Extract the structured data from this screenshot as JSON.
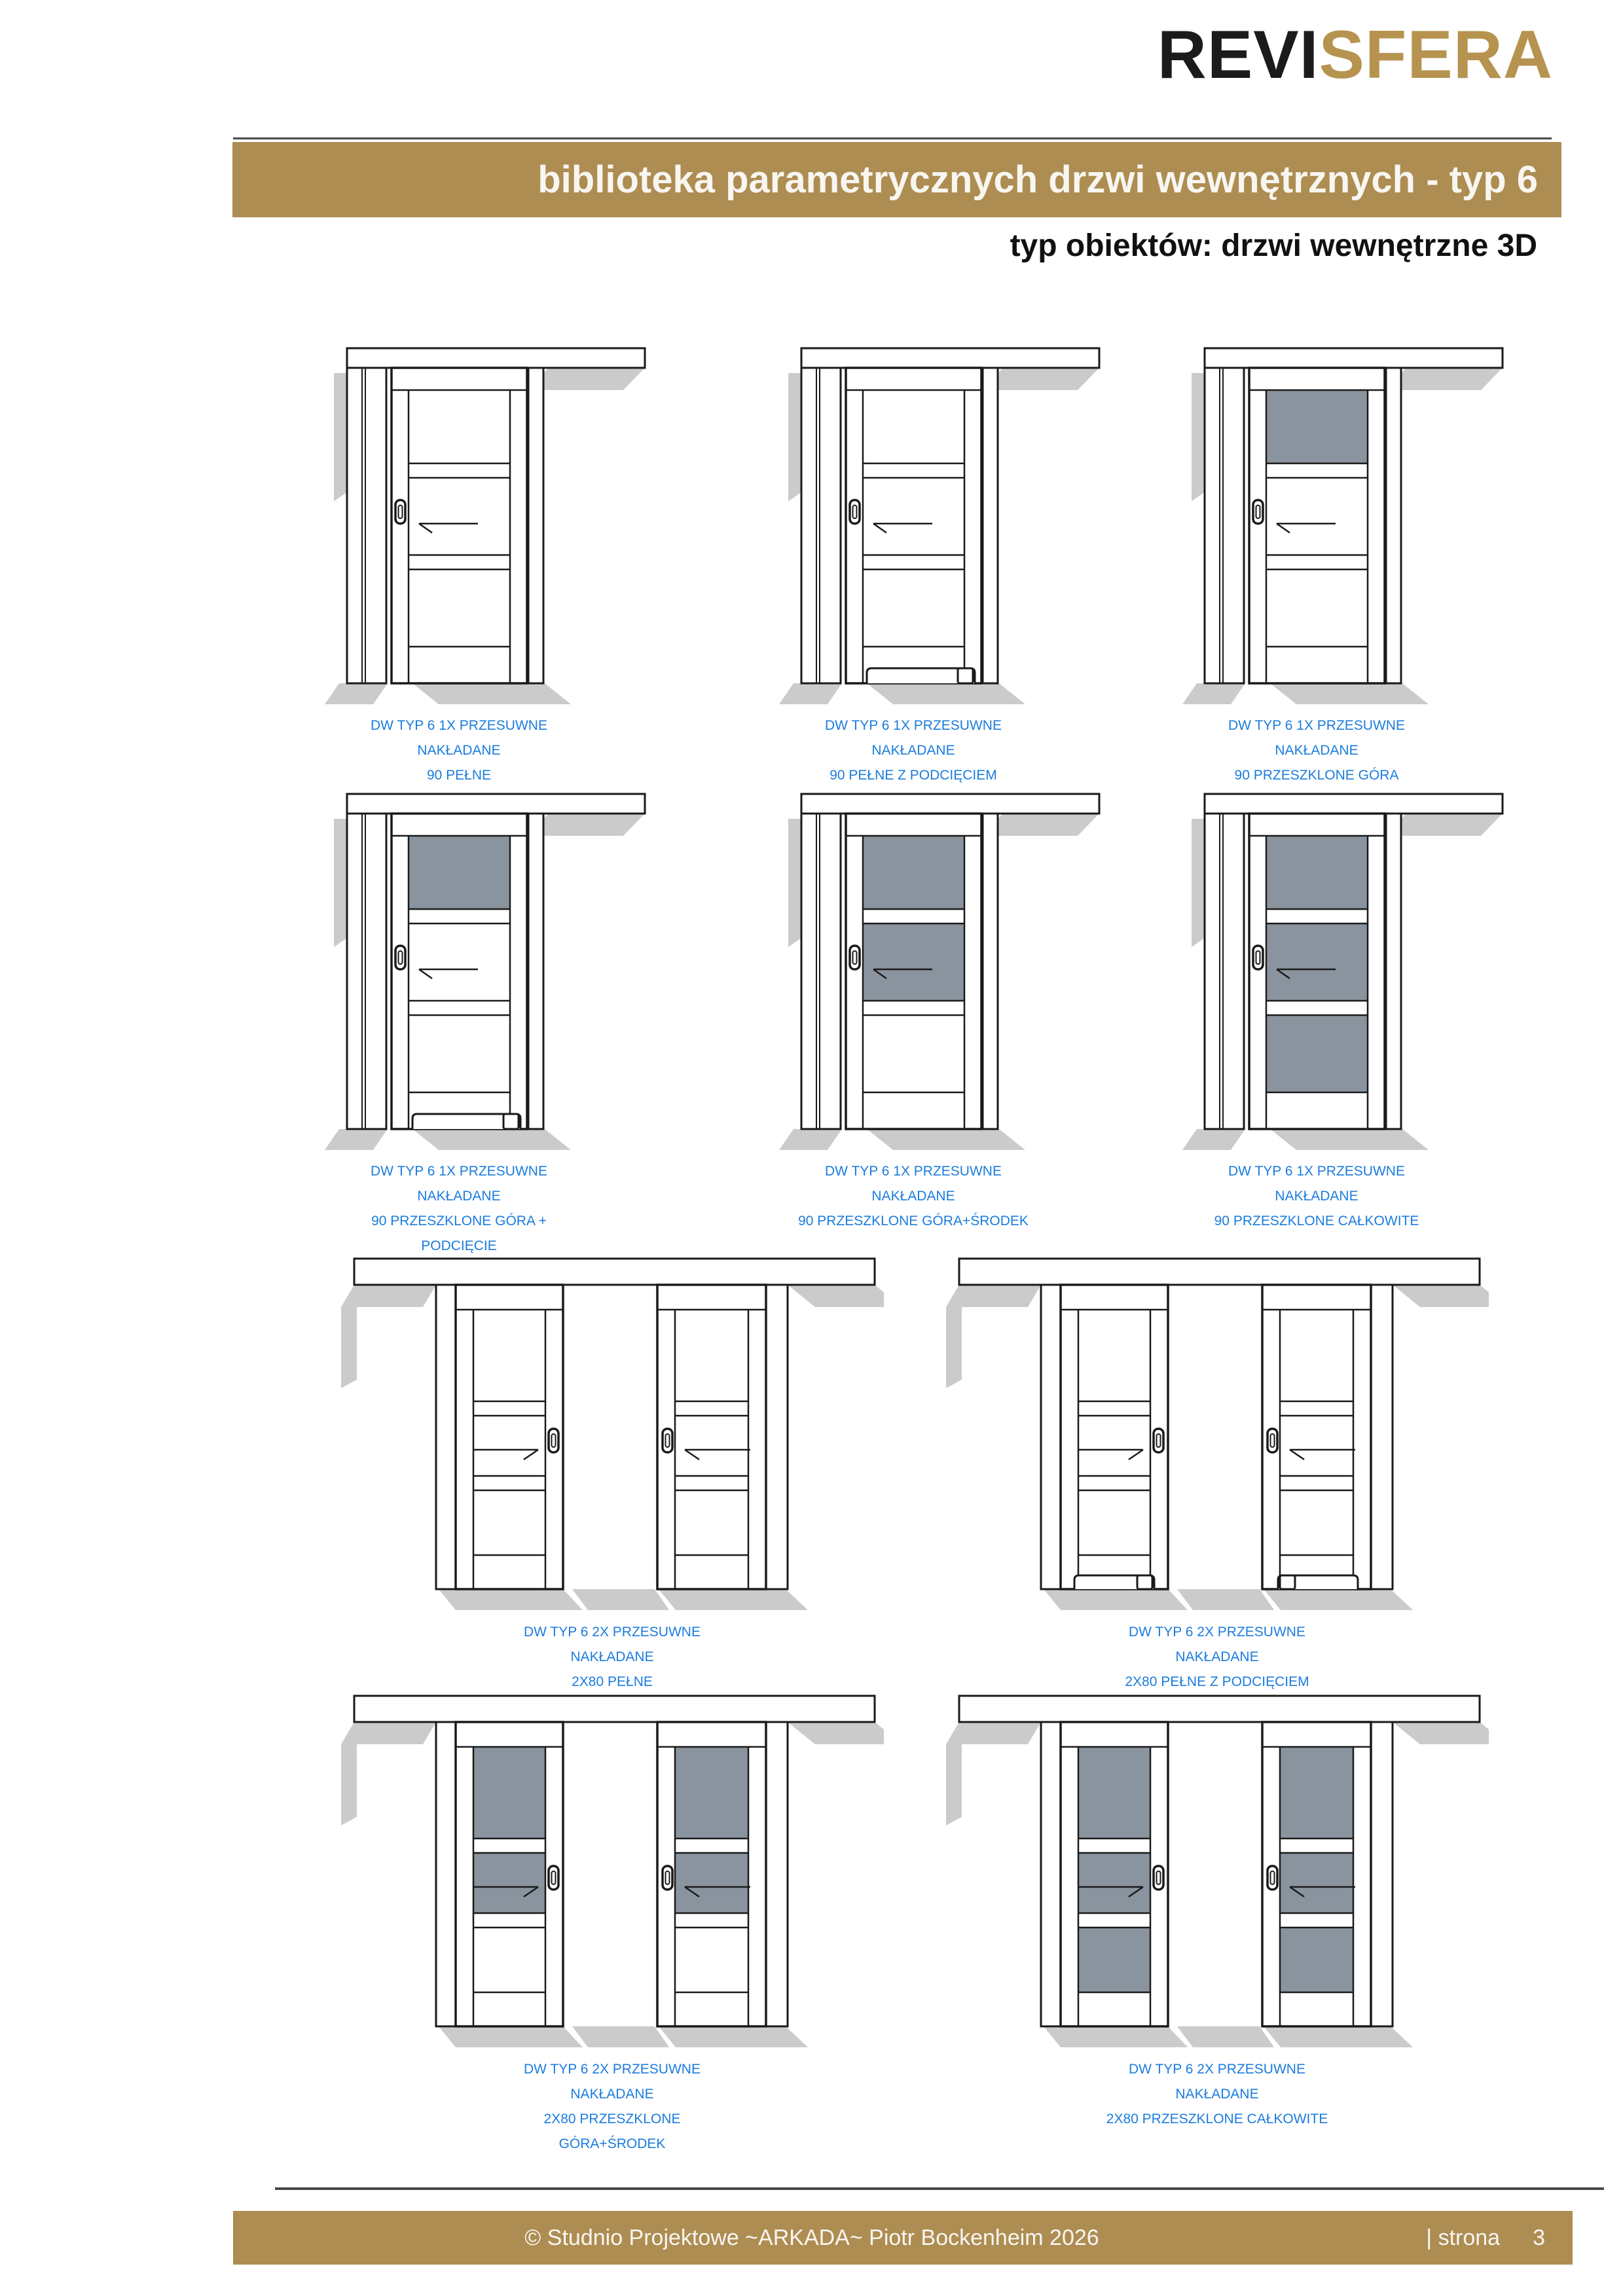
{
  "header": {
    "logo_part1": "REVI",
    "logo_part2": "SFERA",
    "banner": "biblioteka parametrycznych drzwi wewnętrznych - typ 6",
    "subtitle": "typ obiektów: drzwi wewnętrzne 3D"
  },
  "footer": {
    "copyright": "© Studnio Projektowe ~ARKADA~ Piotr Bockenheim 2026",
    "page_label": "| strona",
    "page_number": "3"
  },
  "colors": {
    "gold_band": "#ae8d52",
    "logo_gold": "#b6934f",
    "logo_dark": "#1b1b1b",
    "caption_blue": "#1b7cdd",
    "glass_gray": "#8a949e",
    "shadow_gray": "#cbcbcb",
    "line_black": "#1a1a1a"
  },
  "doors": [
    {
      "kind": "single",
      "panels": [
        "solid",
        "solid",
        "solid"
      ],
      "undercut": false,
      "caption": [
        "DW TYP 6 1X PRZESUWNE",
        "NAKŁADANE",
        "90 PEŁNE"
      ]
    },
    {
      "kind": "single",
      "panels": [
        "solid",
        "solid",
        "solid"
      ],
      "undercut": true,
      "caption": [
        "DW TYP 6 1X PRZESUWNE",
        "NAKŁADANE",
        "90 PEŁNE Z PODCIĘCIEM"
      ]
    },
    {
      "kind": "single",
      "panels": [
        "glass",
        "solid",
        "solid"
      ],
      "undercut": false,
      "caption": [
        "DW TYP 6 1X PRZESUWNE",
        "NAKŁADANE",
        "90 PRZESZKLONE GÓRA"
      ]
    },
    {
      "kind": "single",
      "panels": [
        "glass",
        "solid",
        "solid"
      ],
      "undercut": true,
      "caption": [
        "DW TYP 6 1X PRZESUWNE",
        "NAKŁADANE",
        "90 PRZESZKLONE GÓRA +",
        "PODCIĘCIE"
      ]
    },
    {
      "kind": "single",
      "panels": [
        "glass",
        "glass",
        "solid"
      ],
      "undercut": false,
      "caption": [
        "DW TYP 6 1X PRZESUWNE",
        "NAKŁADANE",
        "90 PRZESZKLONE GÓRA+ŚRODEK"
      ]
    },
    {
      "kind": "single",
      "panels": [
        "glass",
        "glass",
        "glass"
      ],
      "undercut": false,
      "caption": [
        "DW TYP 6 1X PRZESUWNE",
        "NAKŁADANE",
        "90 PRZESZKLONE CAŁKOWITE"
      ]
    },
    {
      "kind": "double",
      "panels": [
        "solid",
        "solid",
        "solid"
      ],
      "undercut": false,
      "caption": [
        "DW TYP 6 2X PRZESUWNE",
        "NAKŁADANE",
        "2X80 PEŁNE"
      ]
    },
    {
      "kind": "double",
      "panels": [
        "solid",
        "solid",
        "solid"
      ],
      "undercut": true,
      "caption": [
        "DW TYP 6 2X PRZESUWNE",
        "NAKŁADANE",
        "2X80 PEŁNE Z PODCIĘCIEM"
      ]
    },
    {
      "kind": "double",
      "panels": [
        "glass",
        "glass",
        "solid"
      ],
      "undercut": false,
      "caption": [
        "DW TYP 6 2X PRZESUWNE",
        "NAKŁADANE",
        "2X80 PRZESZKLONE",
        "GÓRA+ŚRODEK"
      ]
    },
    {
      "kind": "double",
      "panels": [
        "glass",
        "glass",
        "glass"
      ],
      "undercut": false,
      "caption": [
        "DW TYP 6 2X PRZESUWNE",
        "NAKŁADANE",
        "2X80 PRZESZKLONE CAŁKOWITE"
      ]
    }
  ]
}
